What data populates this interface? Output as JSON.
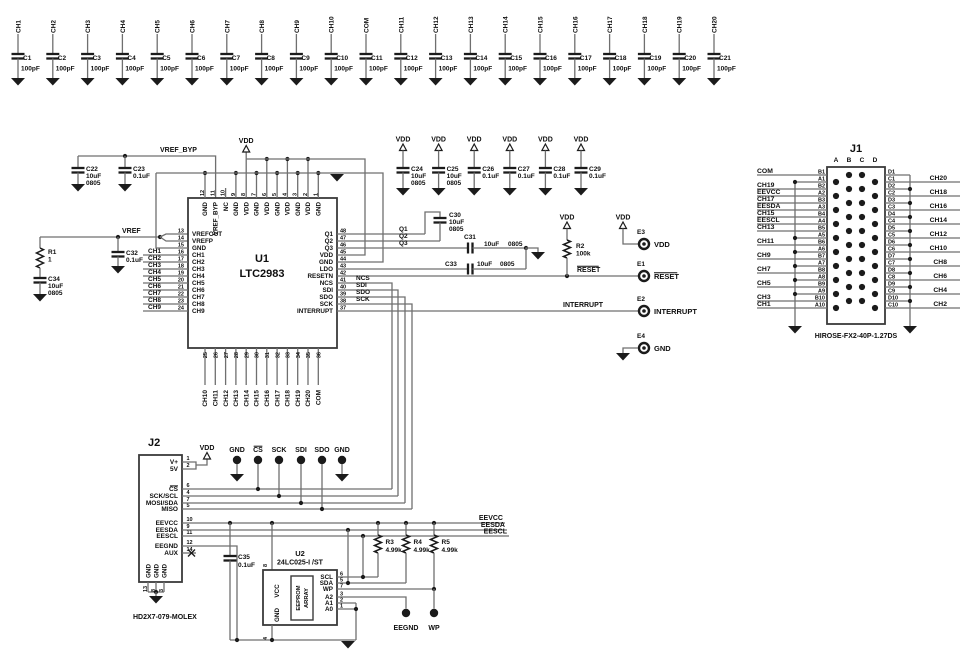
{
  "colors": {
    "wire": "#6f6f6f",
    "symbol": "#1b1b1b",
    "text": "#0e0e0e",
    "box": "#3a3a3a",
    "bg": "#ffffff"
  },
  "power_labels": {
    "vdd": "VDD",
    "gnd": "GND"
  },
  "net_labels": {
    "vref": "VREF",
    "vref_byp": "VREF_BYP",
    "q1": "Q1",
    "q2": "Q2",
    "q3": "Q3",
    "ncs": "NCS",
    "sdi": "SDI",
    "sdo": "SDO",
    "sck": "SCK",
    "reset": "RESET",
    "interrupt": "INTERRUPT",
    "eevcc": "EEVCC",
    "eesda": "EESDA",
    "eescl": "EESCL"
  },
  "top_capacitors": {
    "value": "100pF",
    "items": [
      {
        "ch": "CH1",
        "ref": "C1"
      },
      {
        "ch": "CH2",
        "ref": "C2"
      },
      {
        "ch": "CH3",
        "ref": "C3"
      },
      {
        "ch": "CH4",
        "ref": "C4"
      },
      {
        "ch": "CH5",
        "ref": "C5"
      },
      {
        "ch": "CH6",
        "ref": "C6"
      },
      {
        "ch": "CH7",
        "ref": "C7"
      },
      {
        "ch": "CH8",
        "ref": "C8"
      },
      {
        "ch": "CH9",
        "ref": "C9"
      },
      {
        "ch": "CH10",
        "ref": "C10"
      },
      {
        "ch": "COM",
        "ref": "C11"
      },
      {
        "ch": "CH11",
        "ref": "C12"
      },
      {
        "ch": "CH12",
        "ref": "C13"
      },
      {
        "ch": "CH13",
        "ref": "C14"
      },
      {
        "ch": "CH14",
        "ref": "C15"
      },
      {
        "ch": "CH15",
        "ref": "C16"
      },
      {
        "ch": "CH16",
        "ref": "C17"
      },
      {
        "ch": "CH17",
        "ref": "C18"
      },
      {
        "ch": "CH18",
        "ref": "C19"
      },
      {
        "ch": "CH19",
        "ref": "C20"
      },
      {
        "ch": "CH20",
        "ref": "C21"
      }
    ]
  },
  "u1": {
    "ref": "U1",
    "part": "LTC2983",
    "left_pins": [
      {
        "num": "13",
        "name": "VREFOUT"
      },
      {
        "num": "14",
        "name": "VREFP"
      },
      {
        "num": "15",
        "name": "GND"
      },
      {
        "num": "16",
        "name": "CH1"
      },
      {
        "num": "17",
        "name": "CH2"
      },
      {
        "num": "18",
        "name": "CH3"
      },
      {
        "num": "19",
        "name": "CH4"
      },
      {
        "num": "20",
        "name": "CH5"
      },
      {
        "num": "21",
        "name": "CH6"
      },
      {
        "num": "22",
        "name": "CH7"
      },
      {
        "num": "23",
        "name": "CH8"
      },
      {
        "num": "24",
        "name": "CH9"
      }
    ],
    "top_pins": [
      {
        "num": "12",
        "name": "GND"
      },
      {
        "num": "11",
        "name": "VREF_BYP"
      },
      {
        "num": "10",
        "name": "NC"
      },
      {
        "num": "9",
        "name": "GND"
      },
      {
        "num": "8",
        "name": "VDD"
      },
      {
        "num": "7",
        "name": "GND"
      },
      {
        "num": "6",
        "name": "VDD"
      },
      {
        "num": "5",
        "name": "GND"
      },
      {
        "num": "4",
        "name": "VDD"
      },
      {
        "num": "3",
        "name": "GND"
      },
      {
        "num": "2",
        "name": "VDD"
      },
      {
        "num": "1",
        "name": "GND"
      }
    ],
    "right_pins": [
      {
        "num": "48",
        "name": "Q1"
      },
      {
        "num": "47",
        "name": "Q2"
      },
      {
        "num": "46",
        "name": "Q3"
      },
      {
        "num": "45",
        "name": "VDD"
      },
      {
        "num": "44",
        "name": "GND"
      },
      {
        "num": "43",
        "name": "LDO"
      },
      {
        "num": "42",
        "name": "RESETN"
      },
      {
        "num": "41",
        "name": "NCS"
      },
      {
        "num": "40",
        "name": "SDI"
      },
      {
        "num": "39",
        "name": "SDO"
      },
      {
        "num": "38",
        "name": "SCK"
      },
      {
        "num": "37",
        "name": "INTERRUPT"
      }
    ],
    "bottom_pins": [
      {
        "num": "25",
        "name": "CH10"
      },
      {
        "num": "26",
        "name": "CH11"
      },
      {
        "num": "27",
        "name": "CH12"
      },
      {
        "num": "28",
        "name": "CH13"
      },
      {
        "num": "29",
        "name": "CH14"
      },
      {
        "num": "30",
        "name": "CH15"
      },
      {
        "num": "31",
        "name": "CH16"
      },
      {
        "num": "32",
        "name": "CH17"
      },
      {
        "num": "33",
        "name": "CH18"
      },
      {
        "num": "34",
        "name": "CH19"
      },
      {
        "num": "35",
        "name": "CH20"
      },
      {
        "num": "36",
        "name": "COM"
      }
    ]
  },
  "capacitors": {
    "C22": {
      "ref": "C22",
      "value": "10uF",
      "size": "0805"
    },
    "C23": {
      "ref": "C23",
      "value": "0.1uF",
      "size": ""
    },
    "C24": {
      "ref": "C24",
      "value": "10uF",
      "size": "0805"
    },
    "C25": {
      "ref": "C25",
      "value": "10uF",
      "size": "0805"
    },
    "C26": {
      "ref": "C26",
      "value": "0.1uF",
      "size": ""
    },
    "C27": {
      "ref": "C27",
      "value": "0.1uF",
      "size": ""
    },
    "C28": {
      "ref": "C28",
      "value": "0.1uF",
      "size": ""
    },
    "C29": {
      "ref": "C29",
      "value": "0.1uF",
      "size": ""
    },
    "C30": {
      "ref": "C30",
      "value": "10uF",
      "size": "0805"
    },
    "C31": {
      "ref": "C31",
      "value": "10uF",
      "size": "0805"
    },
    "C32": {
      "ref": "C32",
      "value": "0.1uF",
      "size": ""
    },
    "C33": {
      "ref": "C33",
      "value": "10uF",
      "size": "0805"
    },
    "C34": {
      "ref": "C34",
      "value": "10uF",
      "size": "0805"
    },
    "C35": {
      "ref": "C35",
      "value": "0.1uF",
      "size": ""
    }
  },
  "resistors": {
    "R1": {
      "ref": "R1",
      "value": "1"
    },
    "R2": {
      "ref": "R2",
      "value": "100k"
    },
    "R3": {
      "ref": "R3",
      "value": "4.99k"
    },
    "R4": {
      "ref": "R4",
      "value": "4.99k"
    },
    "R5": {
      "ref": "R5",
      "value": "4.99k"
    }
  },
  "turrets": {
    "E1": {
      "ref": "E1",
      "net": "RESET"
    },
    "E2": {
      "ref": "E2",
      "net": "INTERRUPT"
    },
    "E3": {
      "ref": "E3",
      "net": "VDD"
    },
    "E4": {
      "ref": "E4",
      "net": "GND"
    }
  },
  "testpoints": {
    "labels": [
      "GND",
      "CS",
      "SCK",
      "SDI",
      "SDO",
      "GND"
    ],
    "eegnd": "EEGND",
    "wp": "WP"
  },
  "j1": {
    "ref": "J1",
    "part": "HIROSE-FX2-40P-1.27DS",
    "columns": [
      "A",
      "B",
      "C",
      "D"
    ],
    "left_rows": [
      {
        "pin": "B1",
        "net": "COM"
      },
      {
        "pin": "A1",
        "net": ""
      },
      {
        "pin": "B2",
        "net": "CH19"
      },
      {
        "pin": "A2",
        "net": "EEVCC"
      },
      {
        "pin": "B3",
        "net": "CH17"
      },
      {
        "pin": "A3",
        "net": "EESDA"
      },
      {
        "pin": "B4",
        "net": "CH15"
      },
      {
        "pin": "A4",
        "net": "EESCL"
      },
      {
        "pin": "B5",
        "net": "CH13"
      },
      {
        "pin": "A5",
        "net": ""
      },
      {
        "pin": "B6",
        "net": "CH11"
      },
      {
        "pin": "A6",
        "net": ""
      },
      {
        "pin": "B7",
        "net": "CH9"
      },
      {
        "pin": "A7",
        "net": ""
      },
      {
        "pin": "B8",
        "net": "CH7"
      },
      {
        "pin": "A8",
        "net": ""
      },
      {
        "pin": "B9",
        "net": "CH5"
      },
      {
        "pin": "A9",
        "net": ""
      },
      {
        "pin": "B10",
        "net": "CH3"
      },
      {
        "pin": "A10",
        "net": "CH1"
      }
    ],
    "right_rows": [
      {
        "pin": "D1",
        "net": ""
      },
      {
        "pin": "C1",
        "net": "CH20"
      },
      {
        "pin": "D2",
        "net": ""
      },
      {
        "pin": "C2",
        "net": "CH18"
      },
      {
        "pin": "D3",
        "net": ""
      },
      {
        "pin": "C3",
        "net": "CH16"
      },
      {
        "pin": "D4",
        "net": ""
      },
      {
        "pin": "C4",
        "net": "CH14"
      },
      {
        "pin": "D5",
        "net": ""
      },
      {
        "pin": "C5",
        "net": "CH12"
      },
      {
        "pin": "D6",
        "net": ""
      },
      {
        "pin": "C6",
        "net": "CH10"
      },
      {
        "pin": "D7",
        "net": ""
      },
      {
        "pin": "C7",
        "net": "CH8"
      },
      {
        "pin": "D8",
        "net": ""
      },
      {
        "pin": "C8",
        "net": "CH6"
      },
      {
        "pin": "D9",
        "net": ""
      },
      {
        "pin": "C9",
        "net": "CH4"
      },
      {
        "pin": "D10",
        "net": ""
      },
      {
        "pin": "C10",
        "net": "CH2"
      }
    ]
  },
  "j2": {
    "ref": "J2",
    "part": "HD2X7-079-MOLEX",
    "gnd_label": "GND",
    "gnd_nums": [
      "13",
      "8",
      "3"
    ],
    "pins": [
      {
        "name": "V+",
        "num": "1"
      },
      {
        "name": "5V",
        "num": "2"
      },
      {
        "name": "CS",
        "num": "6",
        "overline": true
      },
      {
        "name": "SCK/SCL",
        "num": "4"
      },
      {
        "name": "MOSI/SDA",
        "num": "7"
      },
      {
        "name": "MISO",
        "num": "5"
      },
      {
        "name": "EEVCC",
        "num": "10"
      },
      {
        "name": "EESDA",
        "num": "9"
      },
      {
        "name": "EESCL",
        "num": "11"
      },
      {
        "name": "EEGND",
        "num": "12"
      },
      {
        "name": "AUX",
        "num": "14"
      }
    ]
  },
  "u2": {
    "ref": "U2",
    "part": "24LC025-I /ST",
    "block": [
      "EEPROM",
      "ARRAY"
    ],
    "left_pins": [
      {
        "name": "VCC",
        "num": "8"
      },
      {
        "name": "GND",
        "num": "4"
      }
    ],
    "right_pins": [
      {
        "name": "SCL",
        "num": "6"
      },
      {
        "name": "SDA",
        "num": "5"
      },
      {
        "name": "WP",
        "num": "7"
      },
      {
        "name": "A2",
        "num": "3"
      },
      {
        "name": "A1",
        "num": "2"
      },
      {
        "name": "A0",
        "num": "1"
      }
    ]
  }
}
